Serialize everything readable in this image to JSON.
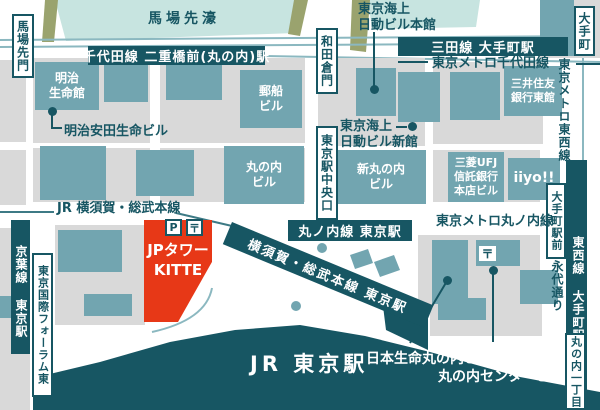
{
  "colors": {
    "dark": "#175663",
    "building": "#72a5b0",
    "block": "#d9d9d9",
    "water": "#c7e4e0",
    "olive": "#9aa36e",
    "red": "#e73817",
    "rail": "#8bb8c0"
  },
  "water": {
    "babasaki_moat": "馬場先濠"
  },
  "banners": {
    "chiyoda_line": "千代田線 二重橋前(丸の内)駅",
    "mita_line": "三田線 大手町駅",
    "marunouchi_line_sta": "丸ノ内線 東京駅",
    "yokosuka_diag": "横須賀・総武本線 東京駅"
  },
  "vbands": {
    "keiyo": "京葉線 東京駅",
    "tozai": "東西線 大手町駅"
  },
  "boxes": {
    "babasakimon": "馬場先門",
    "wadakuramon": "和田倉門",
    "tokyo_chuo_exit": "東京駅中央口",
    "forum_east": "東京国際フォーラム東",
    "otemachi_ekimae": "大手町駅前",
    "marunouchi_itchome": "丸の内一丁目",
    "otemachi": "大手町"
  },
  "lines": {
    "chiyoda_metro": "東京メトロ千代田線",
    "marunouchi_metro": "東京メトロ丸ノ内線",
    "tozai_metro": "東京メトロ東西線",
    "jr_yokosuka": "JR 横須賀・総武本線",
    "eitai_dori": "永代通り"
  },
  "buildings": {
    "meiji_seimeikan": "明治\n生命館",
    "meiji_yasuda": "明治安田生命ビル",
    "yusen": "郵船\nビル",
    "marunouchi_bldg": "丸の内\nビル",
    "tokio_marine_main": "東京海上\n日動ビル本館",
    "tokio_marine_annex": "東京海上\n日動ビル新館",
    "shin_marunouchi": "新丸の内\nビル",
    "smbc_east": "三井住友\n銀行東館",
    "mufg_trust": "三菱UFJ\n信託銀行\n本店ビル",
    "iiyo": "iiyo!!",
    "jp_tower": "JPタワー\nKITTE",
    "nihon_seimei": "日本生命丸の内ビル",
    "marunouchi_center": "丸の内センタービル",
    "jr_tokyo_station": "JR 東京駅"
  },
  "icons": {
    "parking": "P",
    "post": "〒"
  }
}
